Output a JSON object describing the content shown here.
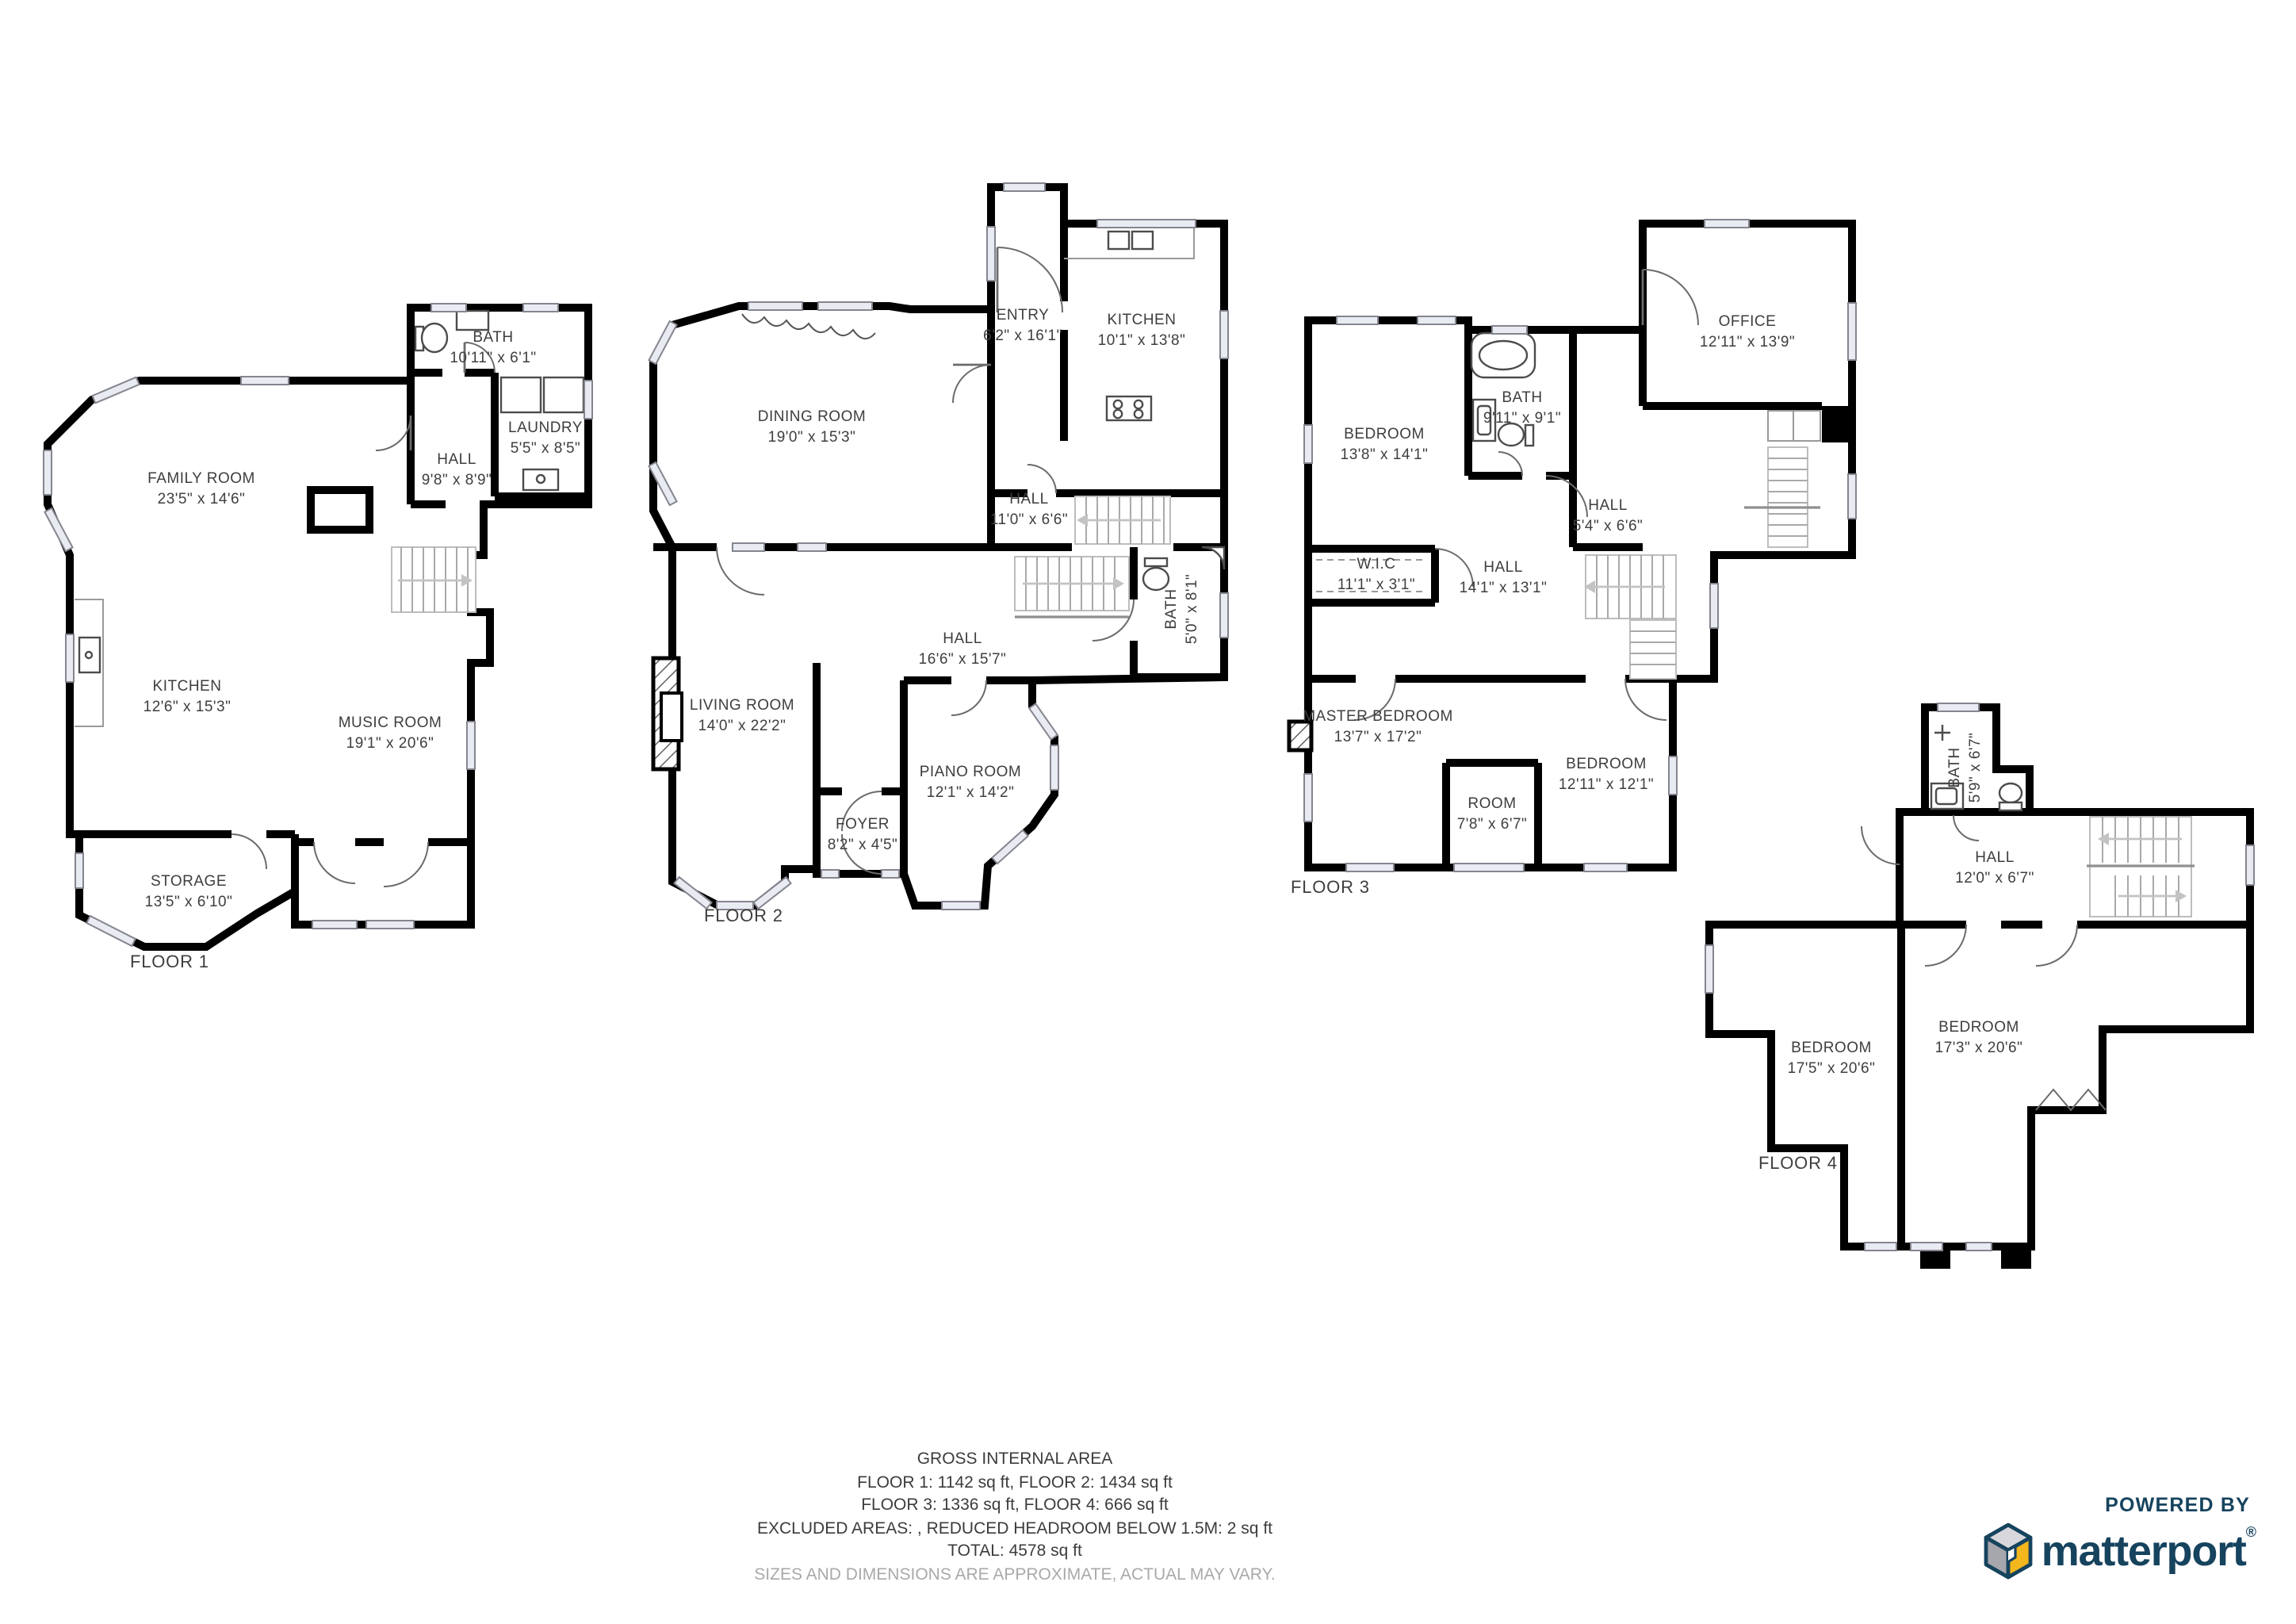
{
  "floors": [
    {
      "id": "floor-1",
      "label": "FLOOR 1",
      "rooms": [
        {
          "name": "BATH",
          "dims": "10'11\" x 6'1\""
        },
        {
          "name": "LAUNDRY",
          "dims": "5'5\" x 8'5\""
        },
        {
          "name": "HALL",
          "dims": "9'8\" x 8'9\""
        },
        {
          "name": "FAMILY ROOM",
          "dims": "23'5\" x 14'6\""
        },
        {
          "name": "KITCHEN",
          "dims": "12'6\" x 15'3\""
        },
        {
          "name": "MUSIC ROOM",
          "dims": "19'1\" x 20'6\""
        },
        {
          "name": "STORAGE",
          "dims": "13'5\" x 6'10\""
        }
      ]
    },
    {
      "id": "floor-2",
      "label": "FLOOR 2",
      "rooms": [
        {
          "name": "ENTRY",
          "dims": "6'2\" x 16'1\""
        },
        {
          "name": "KITCHEN",
          "dims": "10'1\" x 13'8\""
        },
        {
          "name": "DINING ROOM",
          "dims": "19'0\" x 15'3\""
        },
        {
          "name": "HALL",
          "dims": "11'0\" x 6'6\""
        },
        {
          "name": "BATH",
          "dims": "5'0\" x 8'1\""
        },
        {
          "name": "HALL",
          "dims": "16'6\" x 15'7\""
        },
        {
          "name": "LIVING ROOM",
          "dims": "14'0\" x 22'2\""
        },
        {
          "name": "PIANO ROOM",
          "dims": "12'1\" x 14'2\""
        },
        {
          "name": "FOYER",
          "dims": "8'2\" x 4'5\""
        }
      ]
    },
    {
      "id": "floor-3",
      "label": "FLOOR 3",
      "rooms": [
        {
          "name": "BEDROOM",
          "dims": "13'8\" x 14'1\""
        },
        {
          "name": "BATH",
          "dims": "9'11\" x 9'1\""
        },
        {
          "name": "OFFICE",
          "dims": "12'11\" x 13'9\""
        },
        {
          "name": "HALL",
          "dims": "5'4\" x 6'6\""
        },
        {
          "name": "W.I.C",
          "dims": "11'1\" x 3'1\""
        },
        {
          "name": "HALL",
          "dims": "14'1\" x 13'1\""
        },
        {
          "name": "MASTER BEDROOM",
          "dims": "13'7\" x 17'2\""
        },
        {
          "name": "ROOM",
          "dims": "7'8\" x 6'7\""
        },
        {
          "name": "BEDROOM",
          "dims": "12'11\" x 12'1\""
        }
      ]
    },
    {
      "id": "floor-4",
      "label": "FLOOR 4",
      "rooms": [
        {
          "name": "BATH",
          "dims": "5'9\" x 6'7\""
        },
        {
          "name": "HALL",
          "dims": "12'0\" x 6'7\""
        },
        {
          "name": "BEDROOM",
          "dims": "17'5\" x 20'6\""
        },
        {
          "name": "BEDROOM",
          "dims": "17'3\" x 20'6\""
        }
      ]
    }
  ],
  "footer": {
    "title": "GROSS INTERNAL AREA",
    "line1": "FLOOR 1: 1142 sq ft, FLOOR 2: 1434 sq ft",
    "line2": "FLOOR 3: 1336 sq ft, FLOOR 4: 666 sq ft",
    "line3": "EXCLUDED AREAS: , REDUCED HEADROOM BELOW 1.5M: 2 sq ft",
    "line4": "TOTAL: 4578 sq ft",
    "disclaimer": "SIZES AND DIMENSIONS ARE APPROXIMATE, ACTUAL MAY VARY."
  },
  "branding": {
    "powered_by": "POWERED BY",
    "brand": "matterport",
    "registered": "®",
    "colors": {
      "navy": "#16435e",
      "cube_top": "#d8d8dc",
      "cube_left": "#a6a6ad",
      "cube_right": "#f3b71d"
    }
  }
}
